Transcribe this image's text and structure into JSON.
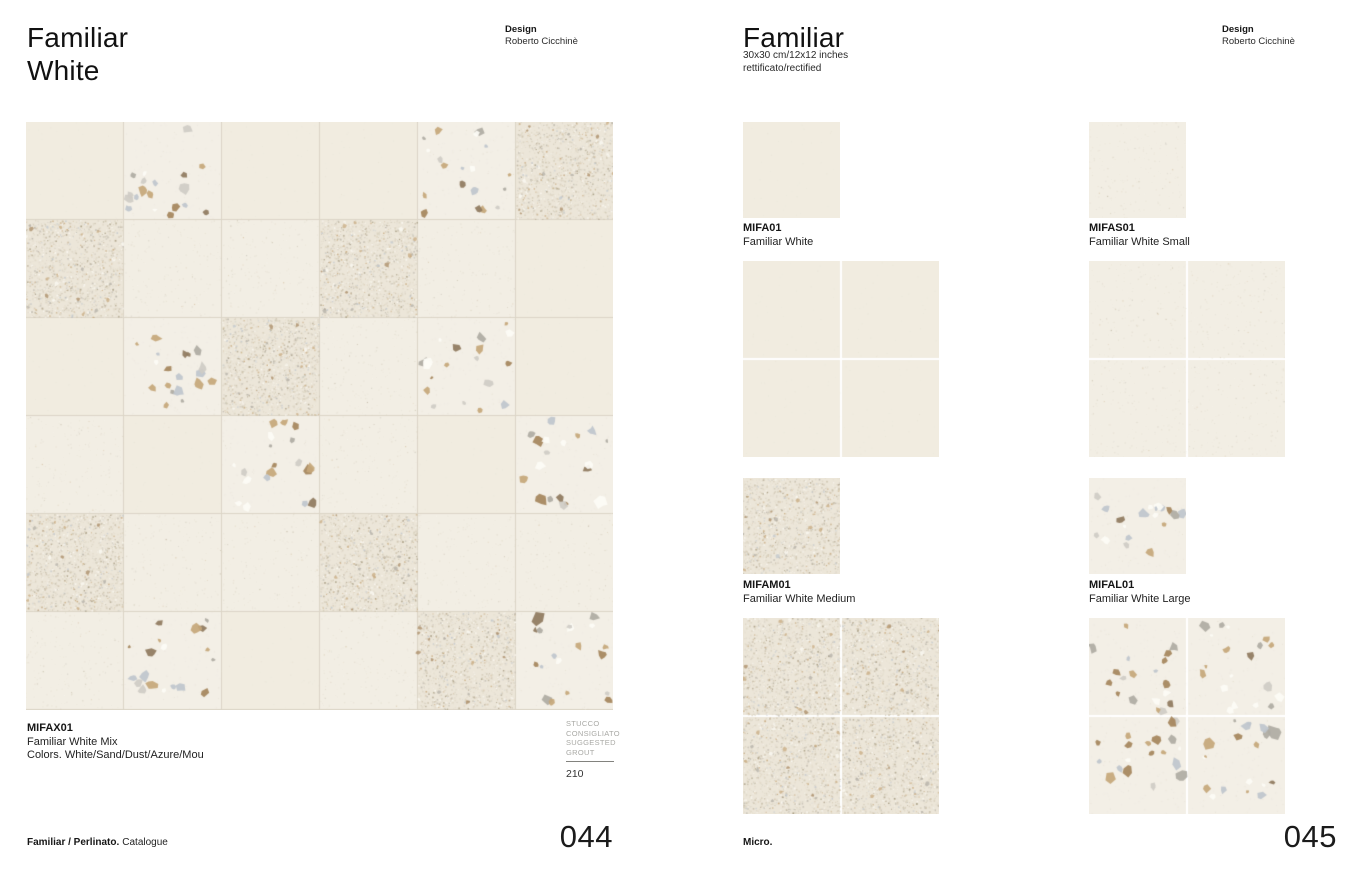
{
  "palette": {
    "page_bg": "#ffffff",
    "tile_plain": "#f1ece0",
    "tile_faint": "#f2eee4",
    "tile_micro": "#ece6d9",
    "tile_large": "#f3efe6",
    "grout_line": "#dcd5c7",
    "grid_gap": "#ffffff",
    "speck_light": "#ddd5c3",
    "speck_mid": "#ccc2ac",
    "speck_dark": "#a2967b",
    "speck_white": "#fcfaf4",
    "speck_gray": "#b7b2a7",
    "chip_sand": "#c6a77a",
    "chip_brown": "#a5855c",
    "chip_gray": "#afaba3",
    "chip_lightgray": "#cfccc5",
    "chip_azure": "#bfc6cd",
    "chip_mou": "#8f7a5e",
    "chip_white": "#fdfcf6",
    "text_dark": "#161616",
    "text_gray": "#a9a9a5"
  },
  "left_page": {
    "title_line1": "Familiar",
    "title_line2": "White",
    "design_label": "Design",
    "designer": "Roberto Cicchinè",
    "mosaic": {
      "rows": [
        [
          "plain",
          "large",
          "plain",
          "plain",
          "large",
          "micro"
        ],
        [
          "micro",
          "faint",
          "faint",
          "micro",
          "faint",
          "plain"
        ],
        [
          "plain",
          "large",
          "micro",
          "faint",
          "large",
          "plain"
        ],
        [
          "faint",
          "plain",
          "large",
          "faint",
          "plain",
          "large"
        ],
        [
          "micro",
          "faint",
          "faint",
          "micro",
          "faint",
          "faint"
        ],
        [
          "faint",
          "large",
          "plain",
          "faint",
          "micro",
          "large"
        ]
      ]
    },
    "caption": {
      "code": "MIFAX01",
      "name": "Familiar White Mix",
      "colors": "Colors. White/Sand/Dust/Azure/Mou"
    },
    "grout": {
      "lines": [
        "STUCCO",
        "CONSIGLIATO",
        "SUGGESTED",
        "GROUT"
      ],
      "value": "210"
    },
    "footer_bold": "Familiar / Perlinato.",
    "footer_regular": "Catalogue",
    "page_number": "044"
  },
  "right_page": {
    "title": "Familiar",
    "size_line1": "30x30 cm/12x12 inches",
    "size_line2": "rettificato/rectified",
    "design_label": "Design",
    "designer": "Roberto Cicchinè",
    "products": [
      {
        "code": "MIFA01",
        "name": "Familiar White",
        "variant": "plain"
      },
      {
        "code": "MIFAS01",
        "name": "Familiar White Small",
        "variant": "faint"
      },
      {
        "code": "MIFAM01",
        "name": "Familiar White Medium",
        "variant": "micro"
      },
      {
        "code": "MIFAL01",
        "name": "Familiar White Large",
        "variant": "large"
      }
    ],
    "footer_bold": "Micro.",
    "page_number": "045"
  }
}
